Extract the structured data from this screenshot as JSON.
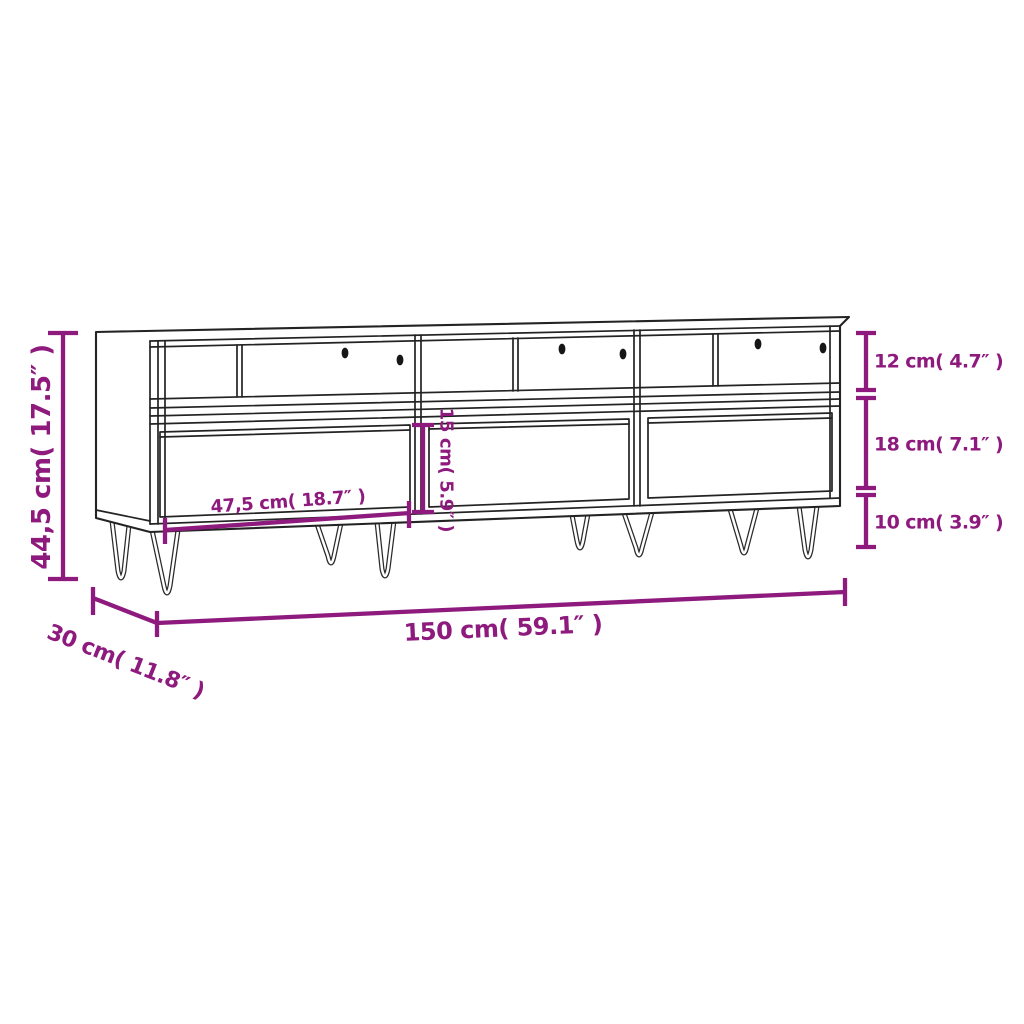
{
  "page": {
    "background_color": "#ffffff",
    "accent_color": "#8E1A7E",
    "outline_color": "#232323",
    "description": "Dimension diagram of a TV cabinet with three open compartments, three drawers and hairpin legs"
  },
  "diagram": {
    "labels": {
      "overall_height": "44,5 cm( 17.5″ )",
      "overall_width": "150 cm( 59.1″ )",
      "overall_depth": "30 cm( 11.8″ )",
      "compartment_height": "12 cm( 4.7″ )",
      "drawer_section_height": "18 cm( 7.1″ )",
      "leg_height": "10 cm( 3.9″ )",
      "drawer_width": "47,5 cm( 18.7″ )",
      "drawer_front_height": "15 cm( 5.9″ )"
    }
  }
}
